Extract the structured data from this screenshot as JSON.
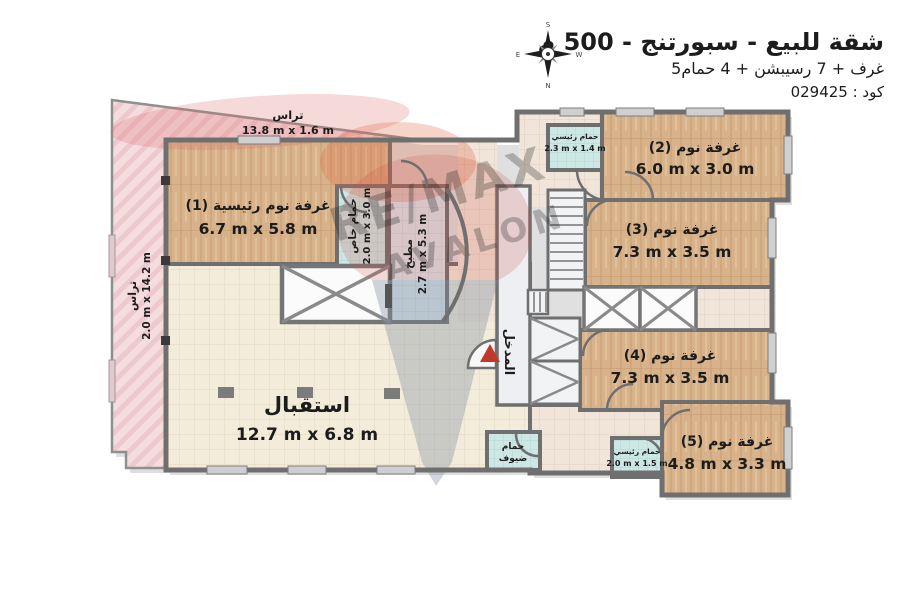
{
  "header": {
    "title": "شقة للبيع - سبورتنج - 500 م",
    "subtitle": "5غرف + 7 رسيبشن + 4 حمام",
    "code": "كود : 029425"
  },
  "compass": {
    "top": "S",
    "bottom": "N",
    "left": "E",
    "right": "W"
  },
  "watermark": {
    "brand": "RE/MAX",
    "office": "AVALON"
  },
  "plan": {
    "terrace_top": {
      "name": "تراس",
      "dims": "13.8 m x 1.6 m"
    },
    "terrace_left": {
      "name": "تراس",
      "dims": "2.0 m x 14.2 m"
    },
    "master_bedroom": {
      "name": "غرفة نوم رئيسية (1)",
      "dims": "6.7 m x 5.8 m"
    },
    "bedroom2": {
      "name": "غرفة نوم (2)",
      "dims": "6.0 m x 3.0 m"
    },
    "bedroom3": {
      "name": "غرفة نوم (3)",
      "dims": "7.3 m x 3.5 m"
    },
    "bedroom4": {
      "name": "غرفة نوم (4)",
      "dims": "7.3 m x 3.5 m"
    },
    "bedroom5": {
      "name": "غرفة نوم (5)",
      "dims": "4.8 m x 3.3 m"
    },
    "reception": {
      "name": "استقبال",
      "dims": "12.7 m x 6.8 m"
    },
    "kitchen": {
      "name": "مطبخ",
      "dims": "2.7 m x 5.3 m"
    },
    "bath_private": {
      "name": "حمام خاص",
      "dims": "2.0 m x 3.0 m"
    },
    "bath_main_top": {
      "name": "حمام رئيسي",
      "dims": "2.3 m x 1.4 m"
    },
    "bath_main_bottom": {
      "name": "حمام رئيسي",
      "dims": "2.0 m x 1.5 m"
    },
    "bath_guest": {
      "line1": "حمام",
      "line2": "ضيوف"
    },
    "entrance": {
      "name": "المدخل"
    }
  },
  "colors": {
    "terrace": "#f5dcde",
    "wood": "#d7b28a",
    "reception_floor": "#f3ecda",
    "bathroom": "#cde7e5",
    "kitchen": "#dae4ea",
    "wall": "#6f6f6f",
    "entrance_arrow": "#c0392b",
    "watermark_red": "#c23a34",
    "watermark_blue": "#3c4c86"
  }
}
